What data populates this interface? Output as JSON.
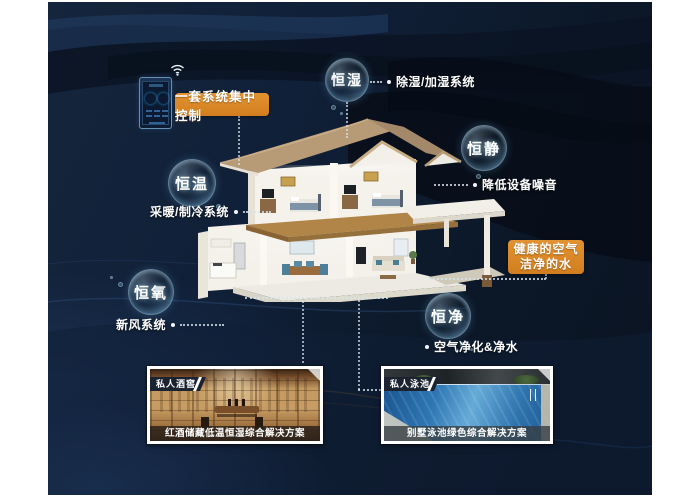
{
  "controller": {
    "badge": "一套系统集中控制"
  },
  "bubbles": {
    "humidity": {
      "label": "恒湿",
      "desc": "除湿/加湿系统"
    },
    "quiet": {
      "label": "恒静",
      "desc": "降低设备噪音"
    },
    "temperature": {
      "label": "恒温",
      "desc": "采暖/制冷系统"
    },
    "oxygen": {
      "label": "恒氧",
      "desc": "新风系统"
    },
    "purity": {
      "label": "恒净",
      "desc": "空气净化&净水"
    }
  },
  "healthy_badge": {
    "line1": "健康的空气",
    "line2": "洁净的水"
  },
  "photos": {
    "wine": {
      "tag": "私人酒窖",
      "caption": "红酒储藏低温恒湿综合解决方案"
    },
    "pool": {
      "tag": "私人泳池",
      "caption": "别墅泳池绿色综合解决方案"
    }
  },
  "colors": {
    "accent_orange": "#d98526",
    "bubble_rim": "#aee0f2",
    "background": "#0e1b2e"
  }
}
